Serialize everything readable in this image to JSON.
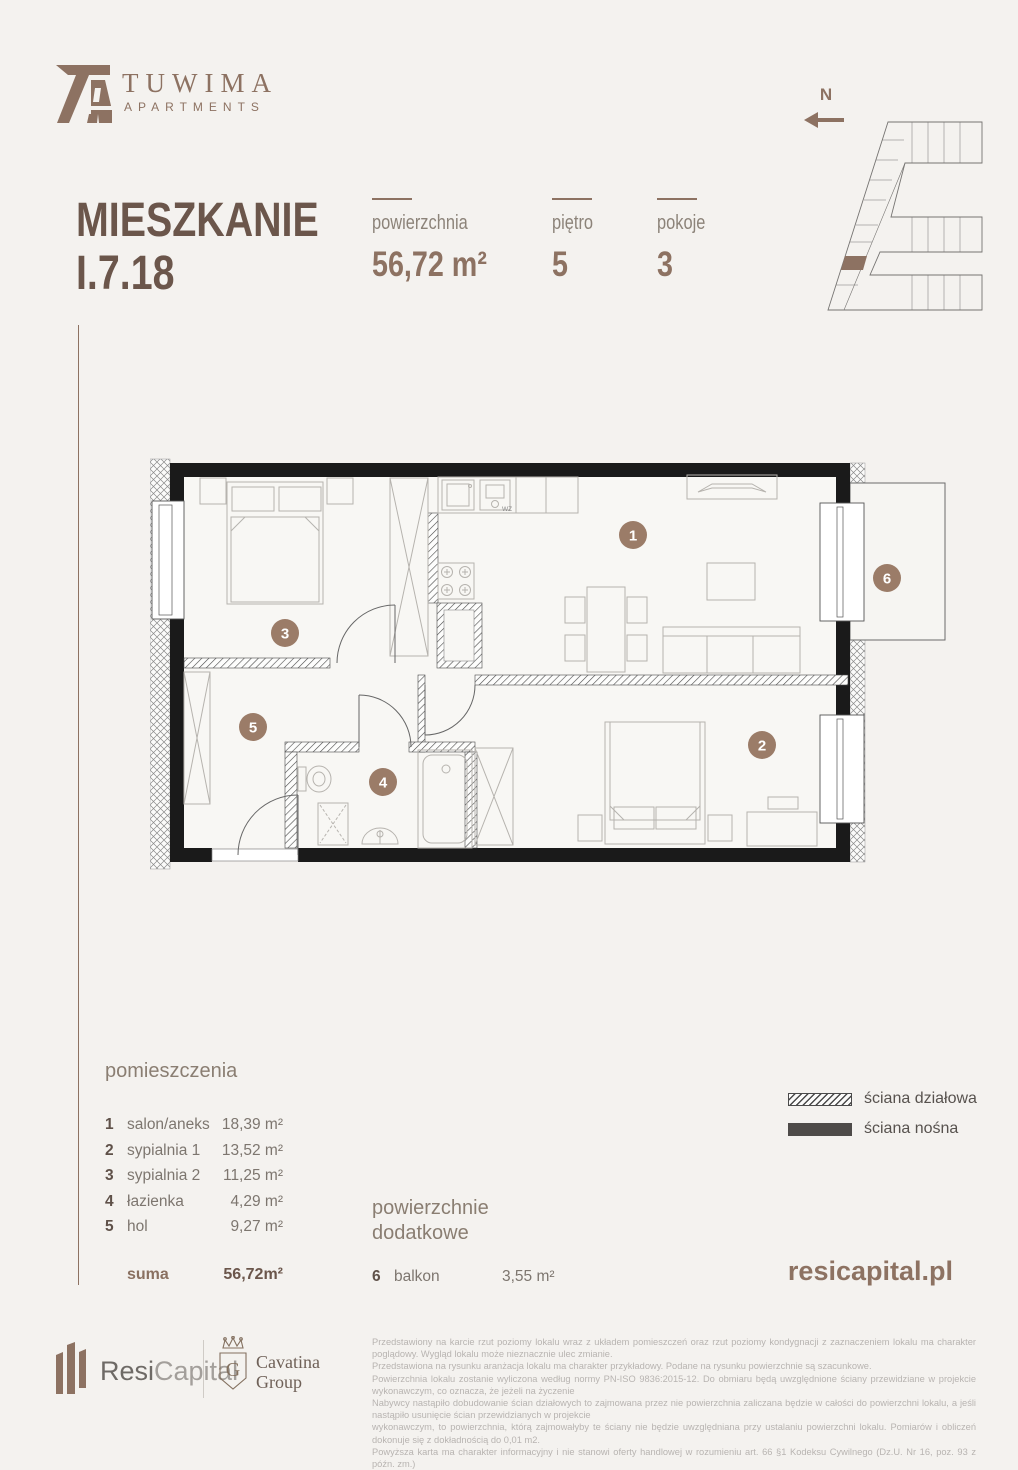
{
  "colors": {
    "accent": "#8d7262",
    "title": "#6b564b",
    "badge": "#9b7c68",
    "wall": "#1a1a1a",
    "legend_solid": "#4e4b49",
    "fineprint": "#b8b4b1"
  },
  "brand": {
    "name": "TUWIMA",
    "sub": "APARTMENTS"
  },
  "title": {
    "line1": "MIESZKANIE",
    "line2": "I.7.18"
  },
  "stats": {
    "items": [
      {
        "label": "powierzchnia",
        "value": "56,72 m²"
      },
      {
        "label": "piętro",
        "value": "5"
      },
      {
        "label": "pokoje",
        "value": "3"
      }
    ]
  },
  "locator": {
    "north_label": "N"
  },
  "plan": {
    "badges": [
      "1",
      "2",
      "3",
      "4",
      "5",
      "6"
    ],
    "wz_label": "WZ"
  },
  "rooms": {
    "heading": "pomieszczenia",
    "items": [
      {
        "no": "1",
        "name": "salon/aneks",
        "area": "18,39 m²"
      },
      {
        "no": "2",
        "name": "sypialnia 1",
        "area": "13,52 m²"
      },
      {
        "no": "3",
        "name": "sypialnia 2",
        "area": "11,25 m²"
      },
      {
        "no": "4",
        "name": "łazienka",
        "area": "4,29 m²"
      },
      {
        "no": "5",
        "name": "hol",
        "area": "9,27 m²"
      }
    ],
    "sum_label": "suma",
    "sum_value": "56,72m²"
  },
  "extras": {
    "heading_line1": "powierzchnie",
    "heading_line2": "dodatkowe",
    "items": [
      {
        "no": "6",
        "name": "balkon",
        "area": "3,55 m²"
      }
    ]
  },
  "legend": {
    "items": [
      {
        "label": "ściana działowa"
      },
      {
        "label": "ściana nośna"
      }
    ]
  },
  "website": "resicapital.pl",
  "footer": {
    "resi_name_dark": "Resi",
    "resi_name_light": "Capital",
    "cavatina_initial": "G",
    "cavatina_line1": "Cavatina",
    "cavatina_line2": "Group",
    "disclaimer": [
      "Przedstawiony na karcie rzut poziomy lokalu wraz z układem pomieszczeń oraz rzut poziomy kondygnacji z zaznaczeniem lokalu ma charakter poglądowy. Wygląd lokalu może nieznacznie ulec zmianie.",
      "Przedstawiona na rysunku aranżacja lokalu ma charakter przykładowy. Podane na rysunku powierzchnie są szacunkowe.",
      "Powierzchnia lokalu zostanie wyliczona według normy PN-ISO 9836:2015-12. Do obmiaru będą uwzględnione ściany przewidziane w projekcie wykonawczym, co oznacza, że jeżeli na życzenie",
      "Nabywcy nastąpiło dobudowanie ścian działowych to zajmowana przez nie powierzchnia zaliczana będzie w całości do powierzchni lokalu, a jeśli nastąpiło usunięcie ścian przewidzianych w projekcie",
      "wykonawczym, to powierzchnia, którą zajmowałyby te ściany nie będzie uwzględniana przy ustalaniu powierzchni lokalu. Pomiarów i obliczeń dokonuje się z dokładnością do 0,01 m2.",
      "Powyższa karta ma charakter informacyjny i nie stanowi oferty handlowej w rozumieniu art. 66 §1 Kodeksu Cywilnego (Dz.U. Nr 16, poz. 93 z późn. zm.)"
    ]
  }
}
